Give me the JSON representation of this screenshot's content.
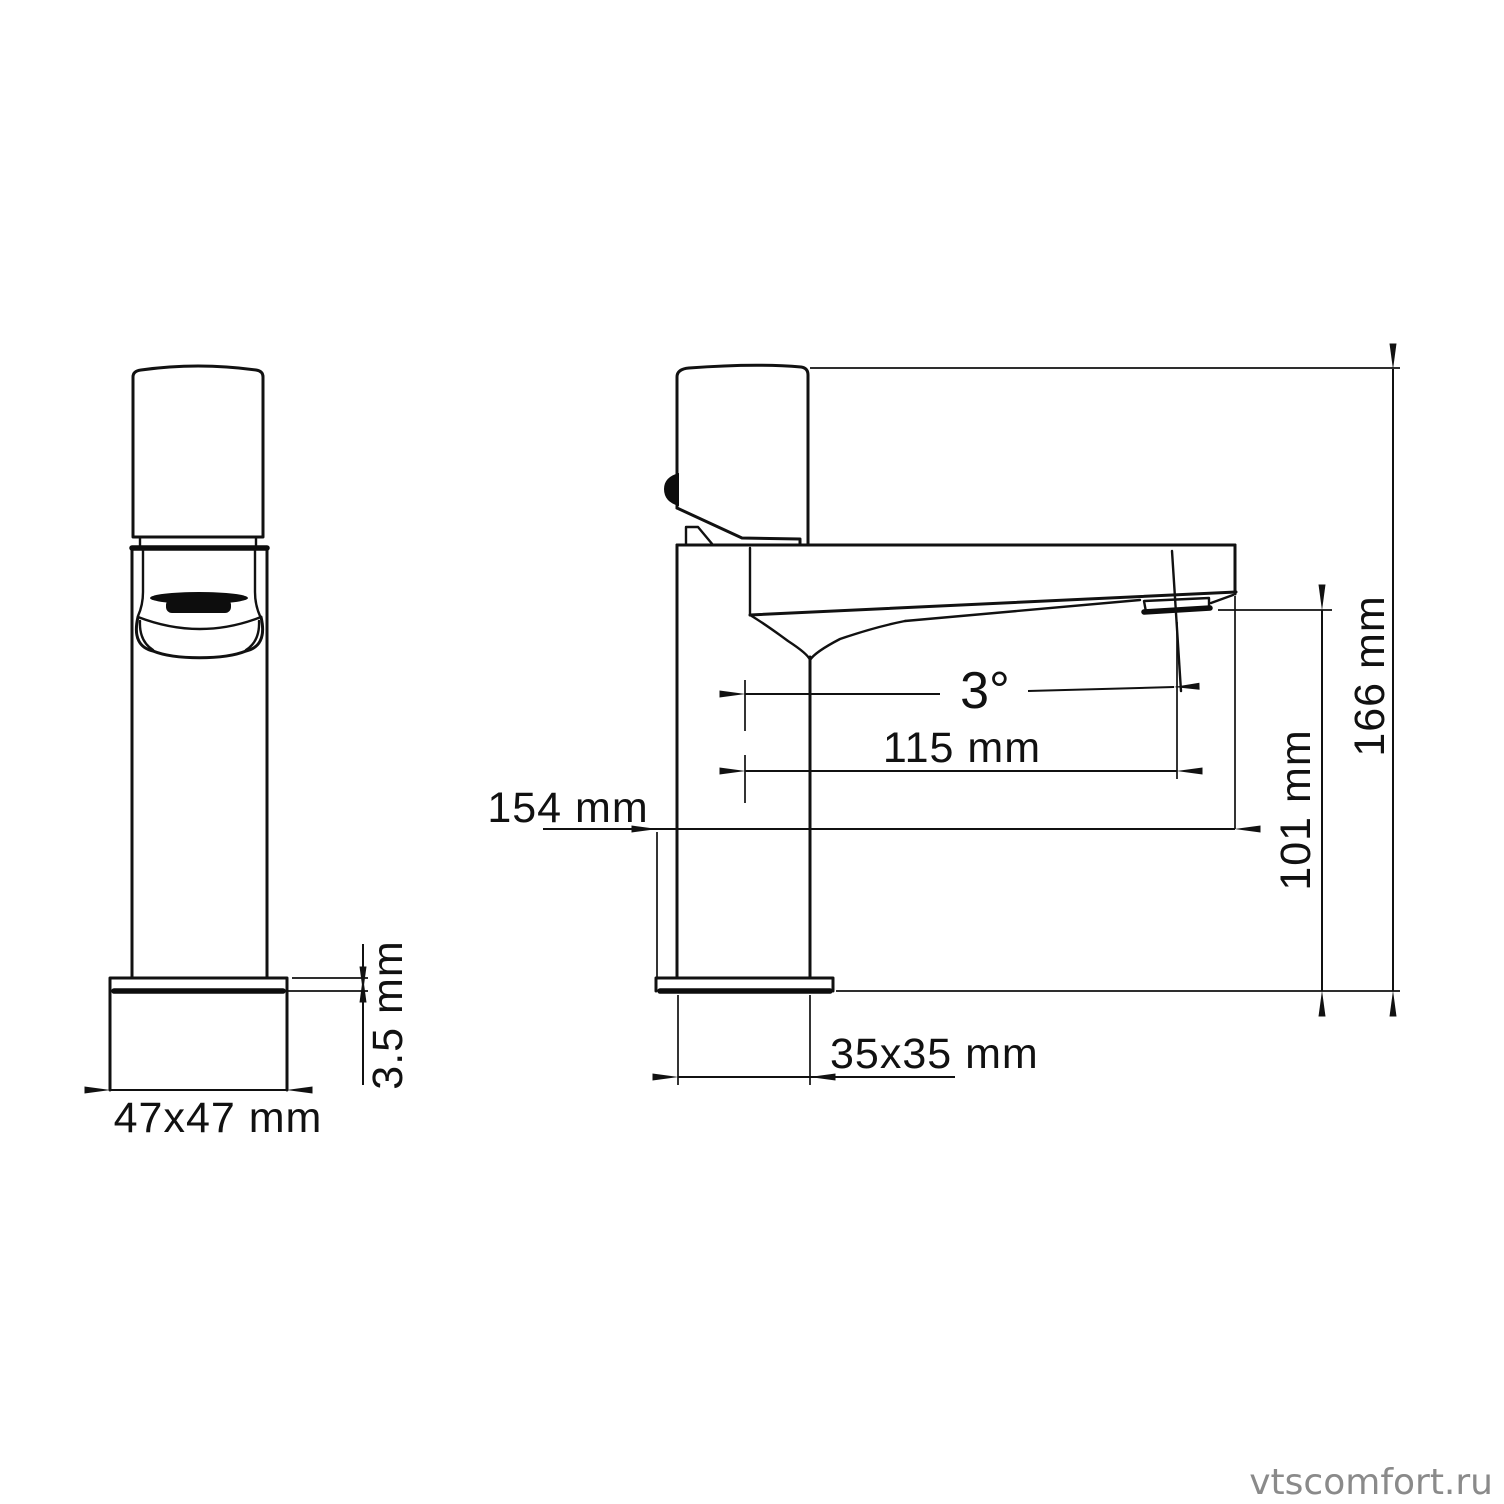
{
  "drawing": {
    "watermark": "vtscomfort.ru",
    "front_view": {
      "base_width": "47x47 mm",
      "plate_thickness": "3.5 mm"
    },
    "side_view": {
      "spout_angle": "3°",
      "spout_reach": "115 mm",
      "total_depth": "154 mm",
      "spout_height": "101 mm",
      "total_height": "166 mm",
      "base_size": "35x35 mm"
    },
    "colors": {
      "line": "#111111",
      "watermark_gray": "#8a8a8a",
      "background": "#ffffff"
    }
  }
}
